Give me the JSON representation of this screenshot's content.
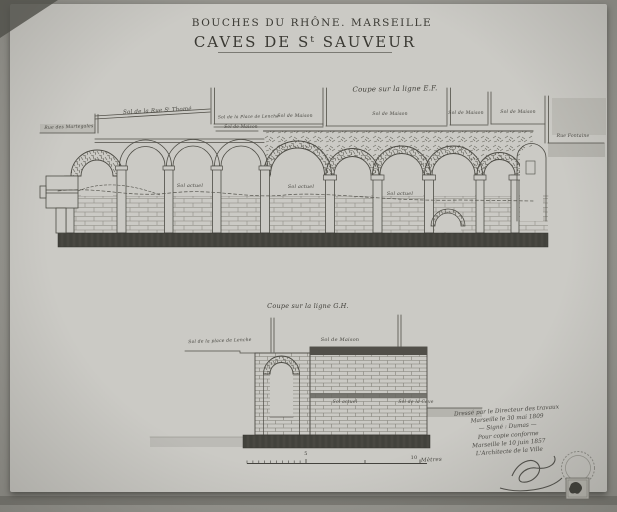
{
  "colors": {
    "paper": "#cbcac5",
    "ink": "#4a4942"
  },
  "header": {
    "region_line": "BOUCHES DU RHÔNE. MARSEILLE",
    "title": "CAVES DE Sᵗ SAUVEUR"
  },
  "ef": {
    "caption": "Coupe sur la ligne E.F.",
    "street_left": "Rue des Martegales",
    "sol_rue": "Sol de la Rue Sᵗ Thomé",
    "sol_place": "Sol de la Place de Lenche",
    "sol_maison": [
      "Sol de Maison",
      "Sol de Maison",
      "Sol de Maison",
      "Sol de Maison",
      "Sol de Maison"
    ],
    "street_right": "Rue Fontaine",
    "sol_actuel": [
      "Sol actuel",
      "Sol actuel",
      "Sol actuel"
    ]
  },
  "gh": {
    "caption": "Coupe sur la ligne G.H.",
    "sol_place": "Sol de la place de Lenche",
    "sol_maison": "Sol de Maison",
    "sol_actuel": "Sol actuel",
    "sol_cave": "Sol de la Cave"
  },
  "scale": {
    "mid": "5",
    "end": "10",
    "unit": "Mètres"
  },
  "note": {
    "line1": "Dressé par le Directeur des travaux",
    "line2": "Marseille le 30 mai 1809",
    "line3": "— Signé : Dumas —",
    "line4": "Pour copie conforme",
    "line5": "Marseille le 10 juin 1857",
    "line6": "L'Architecte de la Ville"
  }
}
